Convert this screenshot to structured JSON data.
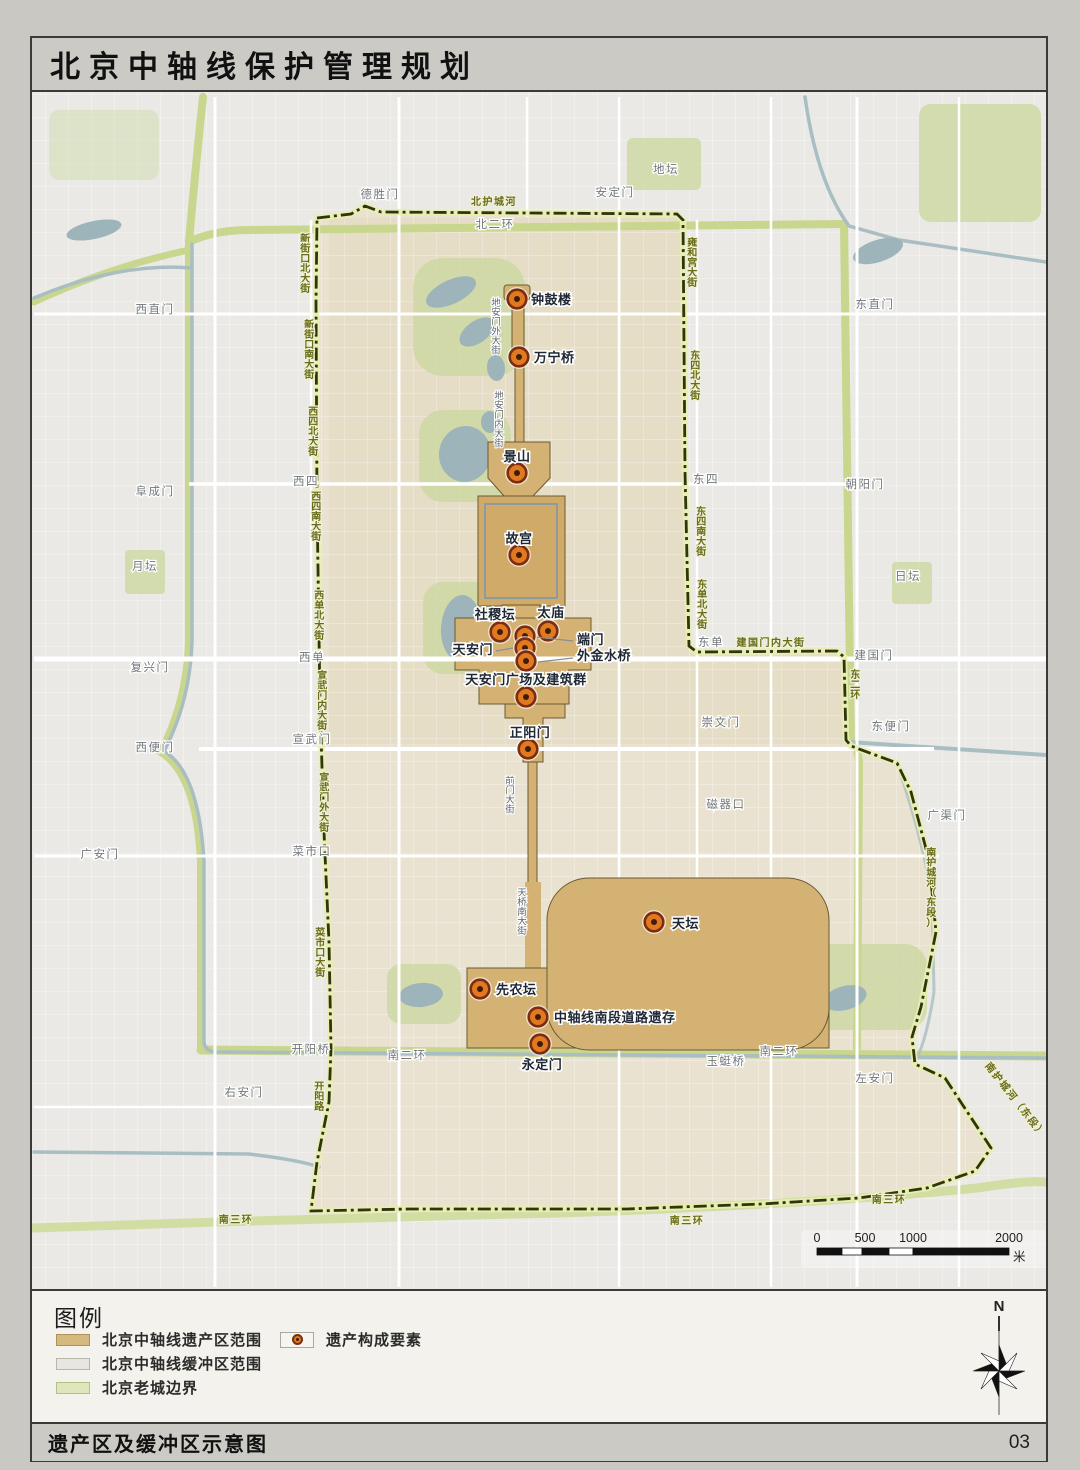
{
  "title": "北京中轴线保护管理规划",
  "footer": {
    "caption": "遗产区及缓冲区示意图",
    "page_number": "03"
  },
  "legend": {
    "heading": "图例",
    "area_items": [
      {
        "label": "北京中轴线遗产区范围",
        "color": "#d5b97e"
      },
      {
        "label": "北京中轴线缓冲区范围",
        "color": "#e7e7e0"
      },
      {
        "label": "北京老城边界",
        "color": "#dfe6bb"
      }
    ],
    "point_item": {
      "label": "遗产构成要素",
      "dot_color": "#e0791f"
    }
  },
  "compass": {
    "north_label": "N"
  },
  "scale_bar": {
    "ticks": [
      "0",
      "500",
      "1000",
      "2000"
    ],
    "unit": "米"
  },
  "map": {
    "colors": {
      "heritage_area": "#d3b274",
      "buffer_area": "#e9e2d0",
      "old_city_line": "#c9d68e",
      "boundary_dash": "#2f350e",
      "marker_fill": "#e0791f",
      "marker_ring": "#7a2d12",
      "marker_core": "#3f1d08",
      "water": "#9db4ba",
      "park": "#ccd9a2"
    },
    "sites": [
      {
        "name": "钟鼓楼",
        "dot": [
          518,
          297
        ],
        "label": [
          532,
          302
        ],
        "anchor": "start"
      },
      {
        "name": "万宁桥",
        "dot": [
          520,
          355
        ],
        "label": [
          535,
          360
        ],
        "anchor": "start"
      },
      {
        "name": "景山",
        "dot": [
          518,
          471
        ],
        "label": [
          518,
          459
        ],
        "anchor": "middle"
      },
      {
        "name": "故宫",
        "dot": [
          520,
          553
        ],
        "label": [
          520,
          541
        ],
        "anchor": "middle"
      },
      {
        "name": "社稷坛",
        "dot": [
          501,
          630
        ],
        "label": [
          496,
          617
        ],
        "anchor": "middle"
      },
      {
        "name": "太庙",
        "dot": [
          549,
          629
        ],
        "label": [
          552,
          615
        ],
        "anchor": "middle"
      },
      {
        "name": "端门",
        "dot": [
          526,
          634
        ],
        "label": [
          578,
          642
        ],
        "anchor": "start",
        "leader": [
          537,
          635,
          574,
          639
        ]
      },
      {
        "name": "天安门",
        "dot": [
          526,
          646
        ],
        "label": [
          494,
          652
        ],
        "anchor": "end",
        "leader": [
          514,
          646,
          497,
          649
        ]
      },
      {
        "name": "外金水桥",
        "dot": [
          527,
          659
        ],
        "label": [
          578,
          658
        ],
        "anchor": "start",
        "leader": [
          539,
          660,
          574,
          656
        ]
      },
      {
        "name": "天安门广场及建筑群",
        "dot": [
          527,
          695
        ],
        "label": [
          527,
          682
        ],
        "anchor": "middle"
      },
      {
        "name": "正阳门",
        "dot": [
          529,
          747
        ],
        "label": [
          531,
          735
        ],
        "anchor": "middle"
      },
      {
        "name": "天坛",
        "dot": [
          655,
          920
        ],
        "label": [
          673,
          926
        ],
        "anchor": "start"
      },
      {
        "name": "先农坛",
        "dot": [
          481,
          987
        ],
        "label": [
          497,
          992
        ],
        "anchor": "start"
      },
      {
        "name": "中轴线南段道路遗存",
        "dot": [
          539,
          1015
        ],
        "label": [
          555,
          1020
        ],
        "anchor": "start"
      },
      {
        "name": "永定门",
        "dot": [
          541,
          1042
        ],
        "label": [
          543,
          1067
        ],
        "anchor": "middle"
      }
    ],
    "labels": [
      {
        "t": "北护城河",
        "x": 495,
        "y": 203,
        "o": "h",
        "s": "road"
      },
      {
        "t": "新街口北大街",
        "x": 307,
        "y": 240,
        "o": "v",
        "s": "road"
      },
      {
        "t": "新街口南大街",
        "x": 311,
        "y": 326,
        "o": "v",
        "s": "road"
      },
      {
        "t": "西四北大街",
        "x": 315,
        "y": 413,
        "o": "v",
        "s": "road"
      },
      {
        "t": "西四南大街",
        "x": 318,
        "y": 498,
        "o": "v",
        "s": "road"
      },
      {
        "t": "西单北大街",
        "x": 321,
        "y": 597,
        "o": "v",
        "s": "road"
      },
      {
        "t": "宣武门内大街",
        "x": 324,
        "y": 677,
        "o": "v",
        "s": "road"
      },
      {
        "t": "宣武门外大街",
        "x": 326,
        "y": 779,
        "o": "v",
        "s": "road"
      },
      {
        "t": "菜市口大街",
        "x": 322,
        "y": 934,
        "o": "v",
        "s": "road"
      },
      {
        "t": "开阳路",
        "x": 321,
        "y": 1088,
        "o": "v",
        "s": "road"
      },
      {
        "t": "雍和宫大街",
        "x": 694,
        "y": 244,
        "o": "v",
        "s": "road"
      },
      {
        "t": "东四北大街",
        "x": 697,
        "y": 357,
        "o": "v",
        "s": "road"
      },
      {
        "t": "东四南大街",
        "x": 703,
        "y": 513,
        "o": "v",
        "s": "road"
      },
      {
        "t": "东单北大街",
        "x": 704,
        "y": 586,
        "o": "v",
        "s": "road"
      },
      {
        "t": "建国门内大街",
        "x": 772,
        "y": 644,
        "o": "h",
        "s": "road"
      },
      {
        "t": "东二环",
        "x": 857,
        "y": 676,
        "o": "v",
        "s": "road"
      },
      {
        "t": "南护城河（东段）",
        "x": 933,
        "y": 854,
        "o": "v",
        "s": "road"
      },
      {
        "t": "南护城河（东段）",
        "x": 1014,
        "y": 1100,
        "o": "h",
        "s": "road",
        "r": 52
      },
      {
        "t": "南三环",
        "x": 237,
        "y": 1221,
        "o": "h",
        "s": "road"
      },
      {
        "t": "南三环",
        "x": 688,
        "y": 1222,
        "o": "h",
        "s": "road"
      },
      {
        "t": "南三环",
        "x": 890,
        "y": 1201,
        "o": "h",
        "s": "road"
      },
      {
        "t": "北二环",
        "x": 496,
        "y": 226,
        "o": "h",
        "s": "place"
      },
      {
        "t": "德胜门",
        "x": 381,
        "y": 196,
        "o": "h",
        "s": "place"
      },
      {
        "t": "安定门",
        "x": 616,
        "y": 194,
        "o": "h",
        "s": "place"
      },
      {
        "t": "地坛",
        "x": 667,
        "y": 171,
        "o": "h",
        "s": "place"
      },
      {
        "t": "东直门",
        "x": 876,
        "y": 306,
        "o": "h",
        "s": "place"
      },
      {
        "t": "西直门",
        "x": 156,
        "y": 311,
        "o": "h",
        "s": "place"
      },
      {
        "t": "阜成门",
        "x": 156,
        "y": 493,
        "o": "h",
        "s": "place"
      },
      {
        "t": "西四",
        "x": 307,
        "y": 483,
        "o": "h",
        "s": "place"
      },
      {
        "t": "东四",
        "x": 707,
        "y": 481,
        "o": "h",
        "s": "place"
      },
      {
        "t": "朝阳门",
        "x": 866,
        "y": 486,
        "o": "h",
        "s": "place"
      },
      {
        "t": "月坛",
        "x": 146,
        "y": 568,
        "o": "h",
        "s": "place"
      },
      {
        "t": "日坛",
        "x": 909,
        "y": 578,
        "o": "h",
        "s": "place"
      },
      {
        "t": "复兴门",
        "x": 151,
        "y": 669,
        "o": "h",
        "s": "place"
      },
      {
        "t": "西单",
        "x": 313,
        "y": 659,
        "o": "h",
        "s": "place"
      },
      {
        "t": "东单",
        "x": 712,
        "y": 644,
        "o": "h",
        "s": "place"
      },
      {
        "t": "建国门",
        "x": 875,
        "y": 657,
        "o": "h",
        "s": "place"
      },
      {
        "t": "宣武门",
        "x": 313,
        "y": 741,
        "o": "h",
        "s": "place"
      },
      {
        "t": "西便门",
        "x": 156,
        "y": 749,
        "o": "h",
        "s": "place"
      },
      {
        "t": "崇文门",
        "x": 722,
        "y": 724,
        "o": "h",
        "s": "place"
      },
      {
        "t": "东便门",
        "x": 892,
        "y": 728,
        "o": "h",
        "s": "place"
      },
      {
        "t": "磁器口",
        "x": 727,
        "y": 806,
        "o": "h",
        "s": "place"
      },
      {
        "t": "广渠门",
        "x": 948,
        "y": 817,
        "o": "h",
        "s": "place"
      },
      {
        "t": "广安门",
        "x": 101,
        "y": 856,
        "o": "h",
        "s": "place"
      },
      {
        "t": "菜市口",
        "x": 313,
        "y": 853,
        "o": "h",
        "s": "place"
      },
      {
        "t": "右安门",
        "x": 245,
        "y": 1094,
        "o": "h",
        "s": "place"
      },
      {
        "t": "开阳桥",
        "x": 312,
        "y": 1051,
        "o": "h",
        "s": "place"
      },
      {
        "t": "玉蜓桥",
        "x": 727,
        "y": 1063,
        "o": "h",
        "s": "place"
      },
      {
        "t": "左安门",
        "x": 876,
        "y": 1080,
        "o": "h",
        "s": "place"
      },
      {
        "t": "南二环",
        "x": 408,
        "y": 1057,
        "o": "h",
        "s": "place"
      },
      {
        "t": "南二环",
        "x": 780,
        "y": 1053,
        "o": "h",
        "s": "place"
      },
      {
        "t": "地安门外大街",
        "x": 497,
        "y": 304,
        "o": "v",
        "s": "axis"
      },
      {
        "t": "地安门内大街",
        "x": 500,
        "y": 397,
        "o": "v",
        "s": "axis"
      },
      {
        "t": "前门大街",
        "x": 511,
        "y": 782,
        "o": "v",
        "s": "axis"
      },
      {
        "t": "天桥南大街",
        "x": 523,
        "y": 894,
        "o": "v",
        "s": "axis"
      }
    ]
  }
}
